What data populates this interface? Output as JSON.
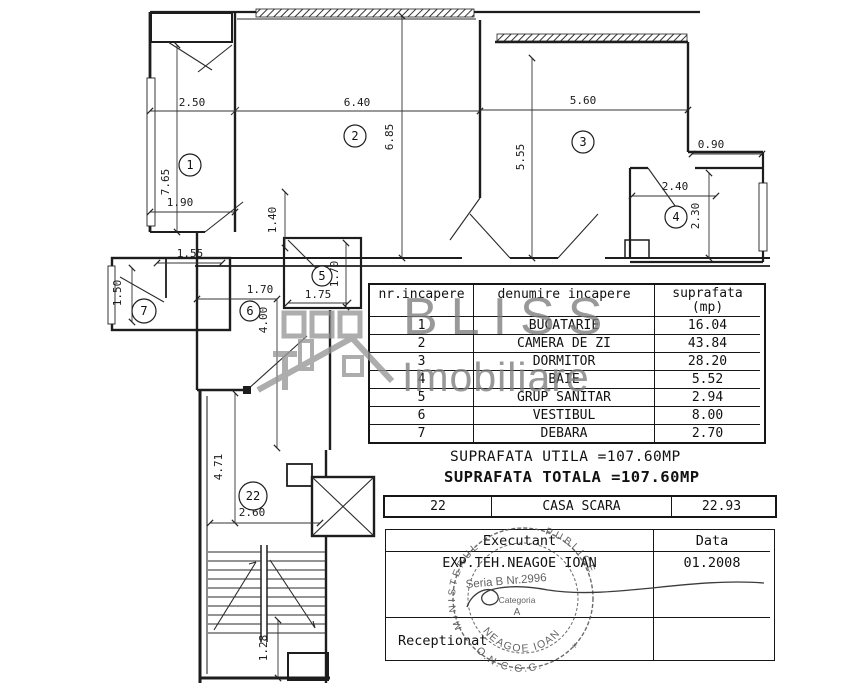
{
  "watermark": {
    "line1": "BLISS",
    "line2": "Imobiliare"
  },
  "room_table": {
    "headers": {
      "col1": "nr.incapere",
      "col2": "denumire incapere",
      "col3_line1": "suprafata",
      "col3_line2": "(mp)"
    },
    "rows": [
      {
        "nr": "1",
        "name": "BUCATARIE",
        "area": "16.04"
      },
      {
        "nr": "2",
        "name": "CAMERA DE ZI",
        "area": "43.84"
      },
      {
        "nr": "3",
        "name": "DORMITOR",
        "area": "28.20"
      },
      {
        "nr": "4",
        "name": "BAIE",
        "area": "5.52"
      },
      {
        "nr": "5",
        "name": "GRUP SANITAR",
        "area": "2.94"
      },
      {
        "nr": "6",
        "name": "VESTIBUL",
        "area": "8.00"
      },
      {
        "nr": "7",
        "name": "DEBARA",
        "area": "2.70"
      }
    ]
  },
  "totals": {
    "utila": "SUPRAFATA UTILA =107.60MP",
    "totala": "SUPRAFATA TOTALA =107.60MP"
  },
  "casa_scara_row": {
    "nr": "22",
    "name": "CASA SCARA",
    "area": "22.93"
  },
  "signature_table": {
    "executant_label": "Executant",
    "data_label": "Data",
    "executant_value": "EXP.TEH.NEAGOE IOAN",
    "data_value": "01.2008",
    "receptionat_label": "Receptionat"
  },
  "stamp": {
    "rim_left": "MINISTERUL",
    "rim_right": "PUBLICE",
    "seria": "Seria B Nr.2996",
    "categoria": "Categoria",
    "letter": "A",
    "name": "NEAGOE IOAN",
    "org": "O.N.C.G.C.",
    "star": "*"
  },
  "floorplan": {
    "rooms": [
      {
        "n": "1",
        "x": 190,
        "y": 165,
        "rad": 11
      },
      {
        "n": "2",
        "x": 355,
        "y": 136,
        "rad": 11
      },
      {
        "n": "3",
        "x": 583,
        "y": 142,
        "rad": 11
      },
      {
        "n": "4",
        "x": 676,
        "y": 217,
        "rad": 11
      },
      {
        "n": "5",
        "x": 322,
        "y": 276,
        "rad": 10
      },
      {
        "n": "6",
        "x": 250,
        "y": 311,
        "rad": 10
      },
      {
        "n": "7",
        "x": 144,
        "y": 311,
        "rad": 12
      },
      {
        "n": "22",
        "x": 253,
        "y": 496,
        "rad": 14
      }
    ],
    "dimensions": [
      {
        "v": "2.50",
        "x": 192,
        "y": 106,
        "r": 0
      },
      {
        "v": "6.40",
        "x": 357,
        "y": 106,
        "r": 0
      },
      {
        "v": "5.60",
        "x": 583,
        "y": 104,
        "r": 0
      },
      {
        "v": "6.85",
        "x": 393,
        "y": 137,
        "r": -90
      },
      {
        "v": "5.55",
        "x": 524,
        "y": 157,
        "r": -90
      },
      {
        "v": "7.65",
        "x": 169,
        "y": 182,
        "r": -90
      },
      {
        "v": "1.90",
        "x": 180,
        "y": 206,
        "r": 0
      },
      {
        "v": "1.40",
        "x": 276,
        "y": 220,
        "r": -90
      },
      {
        "v": "1.55",
        "x": 190,
        "y": 257,
        "r": 0
      },
      {
        "v": "1.50",
        "x": 121,
        "y": 293,
        "r": -90
      },
      {
        "v": "1.70",
        "x": 338,
        "y": 274,
        "r": -90
      },
      {
        "v": "1.75",
        "x": 318,
        "y": 298,
        "r": 0
      },
      {
        "v": "1.70",
        "x": 260,
        "y": 293,
        "r": 0
      },
      {
        "v": "4.00",
        "x": 267,
        "y": 320,
        "r": -90
      },
      {
        "v": "4.71",
        "x": 222,
        "y": 467,
        "r": -90
      },
      {
        "v": "2.60",
        "x": 252,
        "y": 516,
        "r": 0
      },
      {
        "v": "1.28",
        "x": 267,
        "y": 648,
        "r": -90
      },
      {
        "v": "0.90",
        "x": 711,
        "y": 148,
        "r": 0
      },
      {
        "v": "2.40",
        "x": 675,
        "y": 190,
        "r": 0
      },
      {
        "v": "2.30",
        "x": 699,
        "y": 216,
        "r": -90
      }
    ]
  }
}
